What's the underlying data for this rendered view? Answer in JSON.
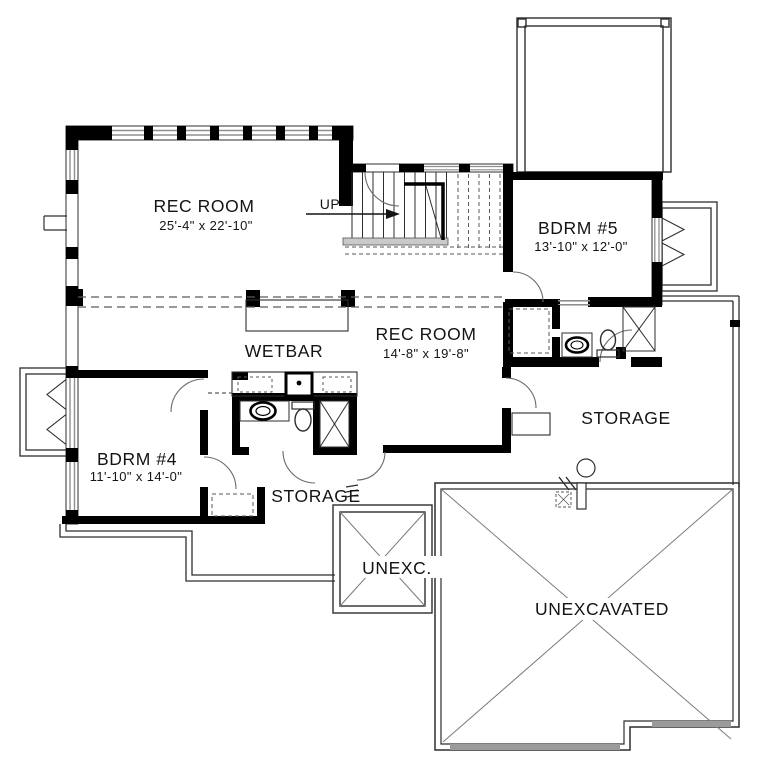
{
  "meta": {
    "drawing_type": "basement floor plan"
  },
  "colors": {
    "wall": "#000000",
    "thin_line": "#2e2e2e",
    "window_line": "#8f8f8f",
    "dashed_line": "#5a5a5a",
    "footing_fill": "#9b9b9b",
    "stair_landing_fill": "#c9c9c9",
    "background": "#ffffff"
  },
  "rooms": [
    {
      "id": "rec-room-main",
      "name": "REC ROOM",
      "dims": "25'-4\" x 22'-10\""
    },
    {
      "id": "rec-room-2",
      "name": "REC ROOM",
      "dims": "14'-8\" x 19'-8\""
    },
    {
      "id": "bdrm-5",
      "name": "BDRM #5",
      "dims": "13'-10\" x 12'-0\""
    },
    {
      "id": "bdrm-4",
      "name": "BDRM #4",
      "dims": "11'-10\" x 14'-0\""
    },
    {
      "id": "wetbar",
      "name": "WETBAR"
    },
    {
      "id": "storage-right",
      "name": "STORAGE"
    },
    {
      "id": "storage-lower",
      "name": "STORAGE"
    },
    {
      "id": "unexcavated-small",
      "name": "UNEXC."
    },
    {
      "id": "unexcavated-large",
      "name": "UNEXCAVATED"
    }
  ],
  "stairs": {
    "direction_label": "UP"
  }
}
